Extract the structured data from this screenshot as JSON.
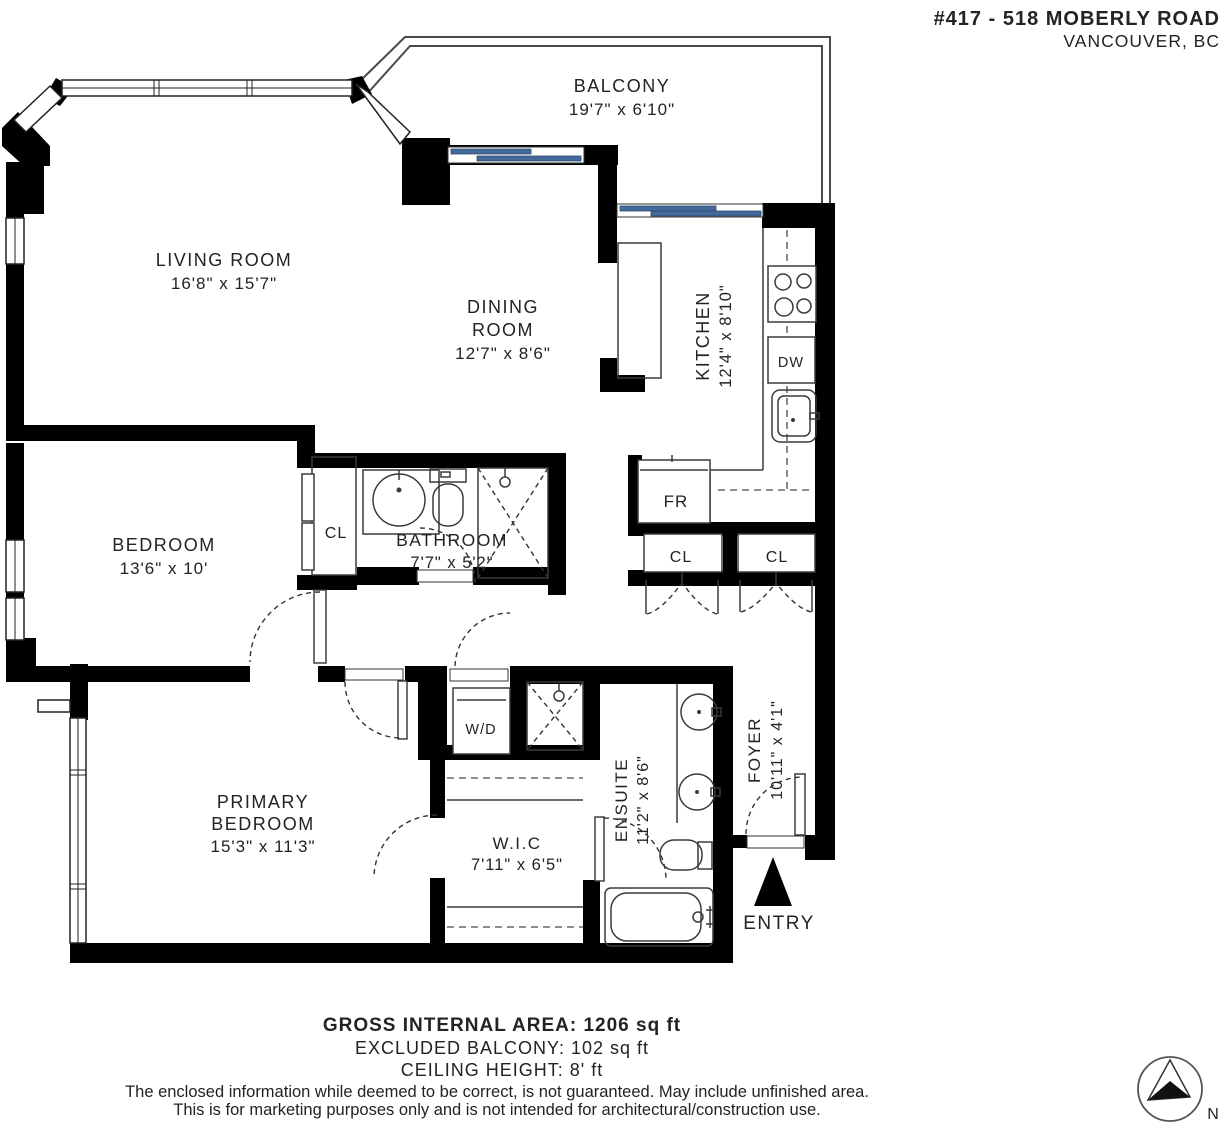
{
  "header": {
    "title": "#417 - 518 MOBERLY ROAD",
    "subtitle": "VANCOUVER, BC"
  },
  "rooms": {
    "balcony": {
      "name": "BALCONY",
      "dims": "19'7\" x 6'10\""
    },
    "living_room": {
      "name": "LIVING ROOM",
      "dims": "16'8\" x 15'7\""
    },
    "dining_room": {
      "line1": "DINING",
      "line2": "ROOM",
      "dims": "12'7\" x 8'6\""
    },
    "kitchen": {
      "name": "KITCHEN",
      "dims": "12'4\" x 8'10\""
    },
    "bedroom": {
      "name": "BEDROOM",
      "dims": "13'6\" x 10'"
    },
    "bathroom": {
      "name": "BATHROOM",
      "dims": "7'7\" x 5'2\""
    },
    "primary_bedroom": {
      "line1": "PRIMARY",
      "line2": "BEDROOM",
      "dims": "15'3\" x 11'3\""
    },
    "walk_in_closet": {
      "name": "W.I.C",
      "dims": "7'11\" x 6'5\""
    },
    "ensuite": {
      "name": "ENSUITE",
      "dims": "11'2\" x 8'6\""
    },
    "foyer": {
      "name": "FOYER",
      "dims": "10'11\" x 4'1\""
    }
  },
  "fixtures": {
    "closet_bedroom": "CL",
    "closet_hall_left": "CL",
    "closet_hall_right": "CL",
    "fridge": "FR",
    "dishwasher": "DW",
    "washer_dryer": "W/D"
  },
  "entry": {
    "label": "ENTRY"
  },
  "compass": {
    "north": "N"
  },
  "footer": {
    "area": "GROSS INTERNAL AREA: 1206 sq ft",
    "balcony": "EXCLUDED BALCONY: 102 sq ft",
    "ceiling": "CEILING HEIGHT: 8' ft",
    "disclaimer1": "The enclosed information while deemed to be correct, is not guaranteed. May include unfinished area.",
    "disclaimer2": "This is for marketing purposes only and is not intended for architectural/construction use."
  },
  "colors": {
    "wall": "#000000",
    "glass": "#44699b",
    "line": "#3a3a3a",
    "text": "#232323"
  }
}
